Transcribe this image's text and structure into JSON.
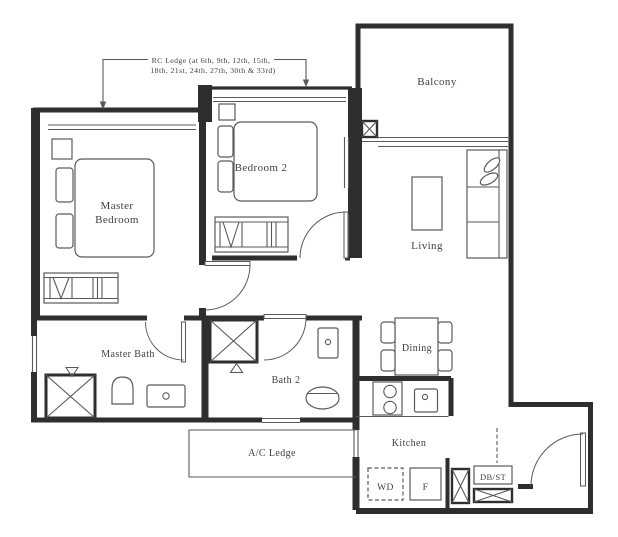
{
  "annotation": {
    "line1": "RC Ledge (at 6th, 9th, 12th, 15th,",
    "line2": "18th, 21st, 24th, 27th, 30th & 33rd)"
  },
  "rooms": {
    "balcony": "Balcony",
    "bedroom2": "Bedroom 2",
    "master_bedroom_line1": "Master",
    "master_bedroom_line2": "Bedroom",
    "living": "Living",
    "master_bath": "Master Bath",
    "bath2": "Bath 2",
    "dining": "Dining",
    "kitchen": "Kitchen",
    "ac_ledge": "A/C Ledge"
  },
  "fixtures": {
    "washer_dryer": "WD",
    "fridge": "F",
    "db_st": "DB/ST"
  },
  "colors": {
    "wall": "#2e2e2e",
    "line": "#5a5a5a",
    "text": "#3f3f3f",
    "background": "#ffffff"
  }
}
